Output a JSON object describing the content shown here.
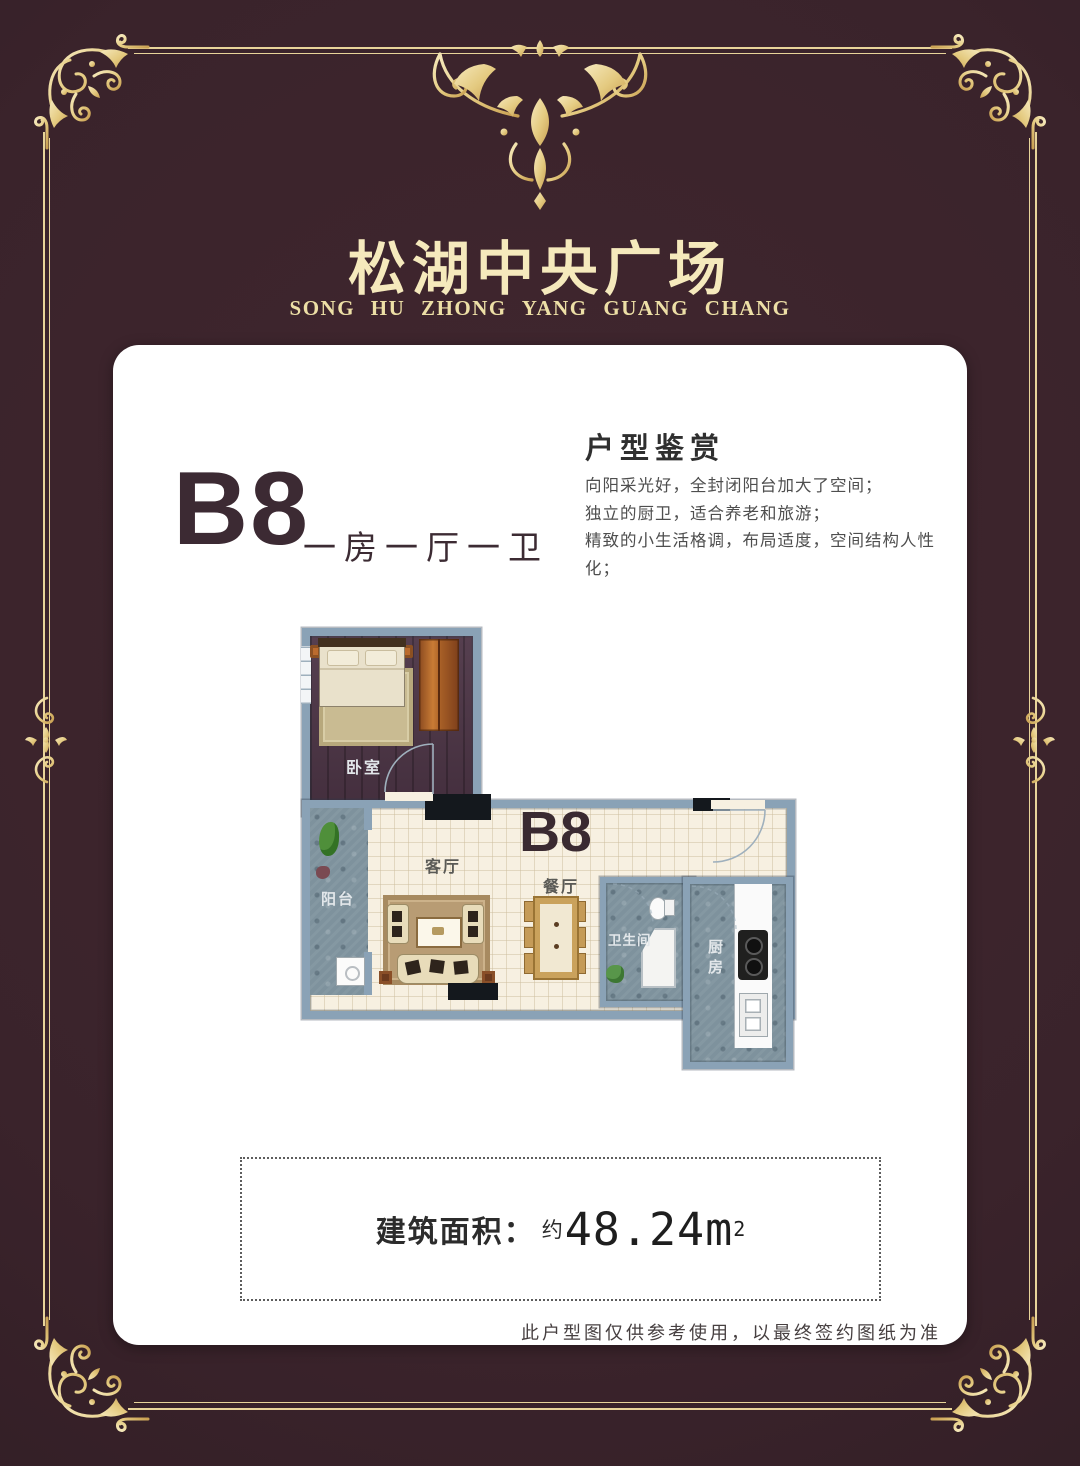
{
  "header": {
    "title": "松湖中央广场",
    "subtitle": "SONG HU ZHONG YANG GUANG CHANG"
  },
  "card": {
    "unit": {
      "code": "B8",
      "layout_label": "一房一厅一卫"
    },
    "review": {
      "heading": "户型鉴赏",
      "lines": [
        "向阳采光好，全封闭阳台加大了空间；",
        "独立的厨卫，适合养老和旅游；",
        "精致的小生活格调，布局适度，空间结构人性化；"
      ]
    },
    "floorplan": {
      "unit_label": "B8",
      "rooms": {
        "bedroom": "卧室",
        "living": "客厅",
        "dining": "餐厅",
        "balcony": "阳台",
        "bathroom": "卫生间",
        "kitchen": "厨房"
      }
    },
    "area": {
      "label": "建筑面积：",
      "approx": "约",
      "value": "48.24m",
      "sup": "2"
    },
    "disclaimer": "此户型图仅供参考使用，以最终签约图纸为准"
  },
  "colors": {
    "background": "#3a232b",
    "gold": "#e8d49a",
    "card": "#ffffff",
    "wall_blue": "#8aa2b6",
    "heading_text": "#3c2a33"
  }
}
